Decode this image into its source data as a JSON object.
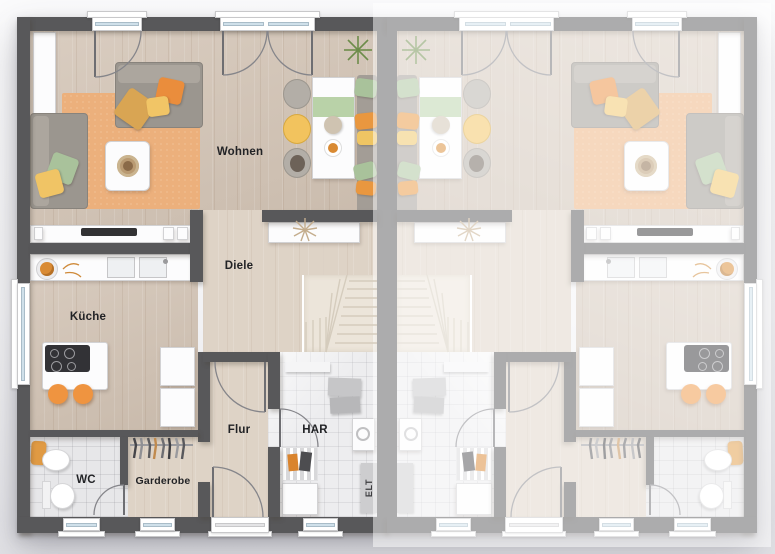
{
  "document": {
    "kind": "residential floor plan",
    "style": "top-down rendered plan of a semi-detached duplex, ground floor"
  },
  "rooms": {
    "wohnen": "Wohnen",
    "diele": "Diele",
    "kueche": "Küche",
    "flur": "Flur",
    "har": "HAR",
    "wc": "WC",
    "garderobe": "Garderobe",
    "elt": "ELT"
  },
  "units": [
    {
      "id": "left",
      "appearance": "full color",
      "labels_visible": true
    },
    {
      "id": "right",
      "appearance": "faded mirrored copy",
      "labels_visible": false
    }
  ],
  "colors": {
    "wall_active": "#58585a",
    "wall_faded": "#ababad",
    "floor_wood": "#d5c7b9",
    "floor_wood_light": "#ded3c6",
    "floor_tile": "#e7e7e9",
    "rug": "#ecb07c",
    "stairs": "#ece5da",
    "accent_orange": "#ef9440",
    "accent_yellow": "#f0c465",
    "accent_green": "#a9c29b",
    "window_glass": "#cfe0ea"
  }
}
